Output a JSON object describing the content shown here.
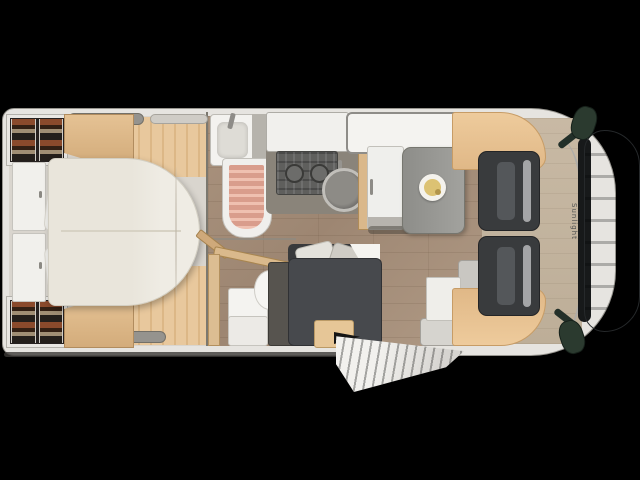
{
  "floorplan": {
    "brand_label": "Sunlight",
    "description": "Motorhome floor plan, top view, cab at right",
    "colors": {
      "background": "#000000",
      "body_shell": "#e6e4e0",
      "wood_floor": "#a38c77",
      "accent_wood": "#e5c294",
      "bed_mattress": "#efece4",
      "sofa_dark": "#47494d",
      "cab_seat": "#393b3d",
      "shower_mat": "#d99d8c",
      "hood_gray": "#4b4f51",
      "mirror_green": "#2b3a2f",
      "table_gray": "#9a9a96",
      "plate_yellow": "#dcc273"
    },
    "areas": {
      "rear_bedroom": [
        "wardrobe shelves (2)",
        "overhead cabinets (2)",
        "headboard cabinets",
        "island bed",
        "pillows (2)",
        "roof vents"
      ],
      "bathroom": [
        "washbasin",
        "shower with mat",
        "toilet",
        "tall cabinet",
        "open door"
      ],
      "kitchen": [
        "worktop",
        "hob",
        "round sink",
        "tall fridge cabinet"
      ],
      "dinette": [
        "table with plate",
        "dark L-sofa with cushions",
        "side bench",
        "skylight",
        "entry mat",
        "open entry door"
      ],
      "cab": [
        "driver seat",
        "passenger seat",
        "over-cab bed bands",
        "dashboard",
        "hood",
        "side mirrors (2)",
        "brand lettering"
      ]
    }
  }
}
